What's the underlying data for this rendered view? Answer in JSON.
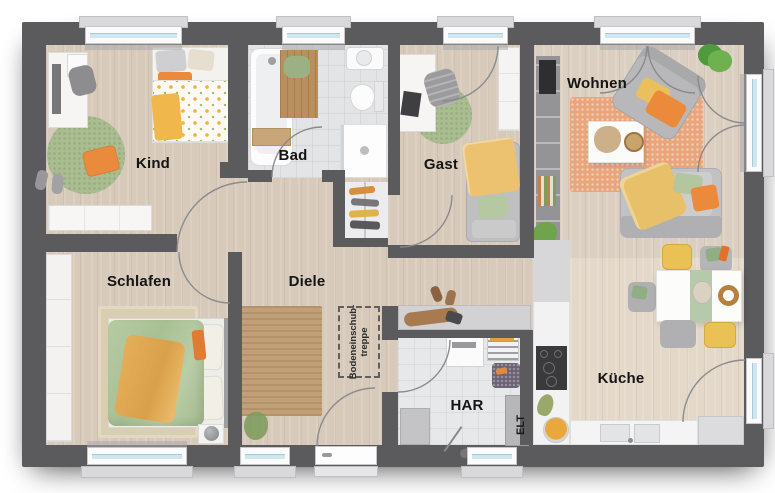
{
  "plan": {
    "title": "Floor plan – single storey house",
    "rooms": [
      {
        "id": "kind",
        "label": "Kind"
      },
      {
        "id": "bad",
        "label": "Bad"
      },
      {
        "id": "gast",
        "label": "Gast"
      },
      {
        "id": "wohnen",
        "label": "Wohnen"
      },
      {
        "id": "schlafen",
        "label": "Schlafen"
      },
      {
        "id": "diele",
        "label": "Diele"
      },
      {
        "id": "har",
        "label": "HAR"
      },
      {
        "id": "elt",
        "label": "ELT"
      },
      {
        "id": "kueche",
        "label": "Küche"
      }
    ],
    "attic_hatch": {
      "line1": "Bodeneinschub-",
      "line2": "treppe"
    },
    "colors": {
      "wall": "#5b5b5e",
      "floor_wood": "#d7cabb",
      "floor_wood_light": "#e4d8c9",
      "floor_tile": "#e3e4e6",
      "accent_orange": "#ea8a3d",
      "accent_yellow": "#eac154",
      "accent_green": "#a9bd90",
      "rug_orange": "#e9a67c",
      "rug_jute": "#c2a077",
      "window_glass": "#cfe6ef"
    }
  }
}
